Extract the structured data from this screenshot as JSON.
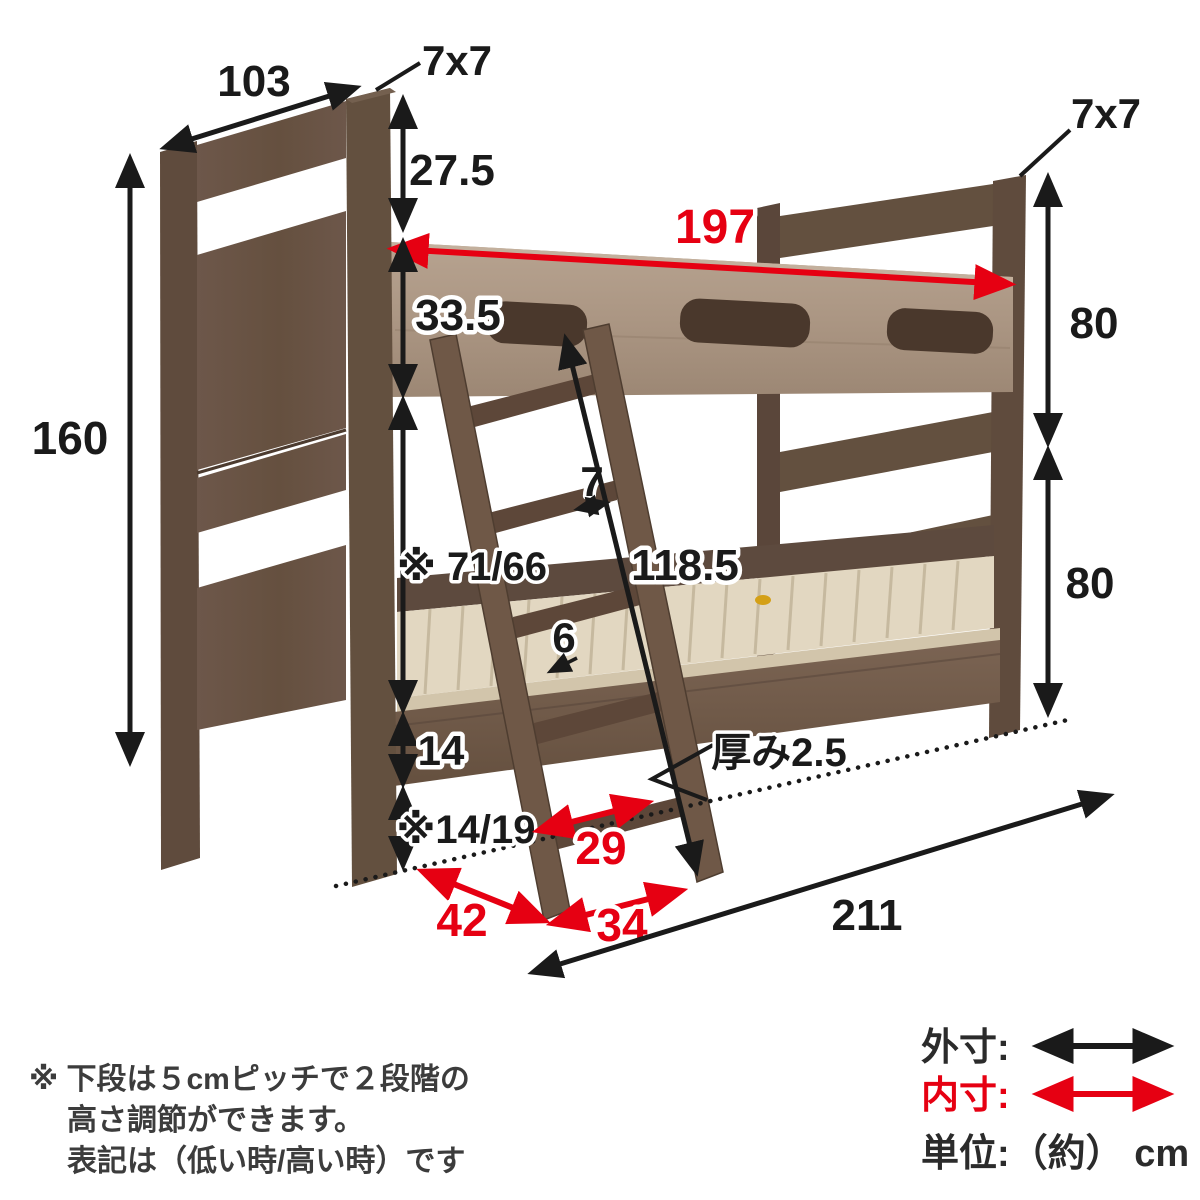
{
  "diagram": {
    "kind": "bunk-bed-dimension-diagram",
    "dims": {
      "headboard_width": "103",
      "post_section_left": "7x7",
      "post_section_right": "7x7",
      "top_clearance": "27.5",
      "inner_length": "197",
      "guard_rail_height": "33.5",
      "total_height": "160",
      "upper_section_height": "80",
      "lower_section_height": "80",
      "under_upper_clearance": "※ 71/66",
      "ladder_rail_width": "7",
      "ladder_length": "118.5",
      "slat_thickness": "6",
      "lower_rail_height": "14",
      "under_bed_clearance": "※14/19",
      "ladder_inner_width": "29",
      "headboard_depth": "42",
      "ladder_foot_depth": "34",
      "board_thickness": "厚み2.5",
      "total_length": "211"
    }
  },
  "legend": {
    "outer_label": "外寸:",
    "inner_label": "内寸:",
    "unit_label": "単位:（約） cm",
    "outer_color": "#1a1a1a",
    "inner_color": "#e60012"
  },
  "footnote": [
    "※ 下段は５cmピッチで２段階の",
    "高さ調節ができます。",
    "表記は（低い時/高い時）です"
  ],
  "colors": {
    "dimension_black": "#1a1a1a",
    "dimension_red": "#e60012",
    "wood_dark_post": "#5f4b3d",
    "wood_panel": "#6d574a",
    "wood_light_rail": "#ab9683",
    "slat_cream": "#e2d7c1",
    "ladder_wood": "#6f5847"
  }
}
